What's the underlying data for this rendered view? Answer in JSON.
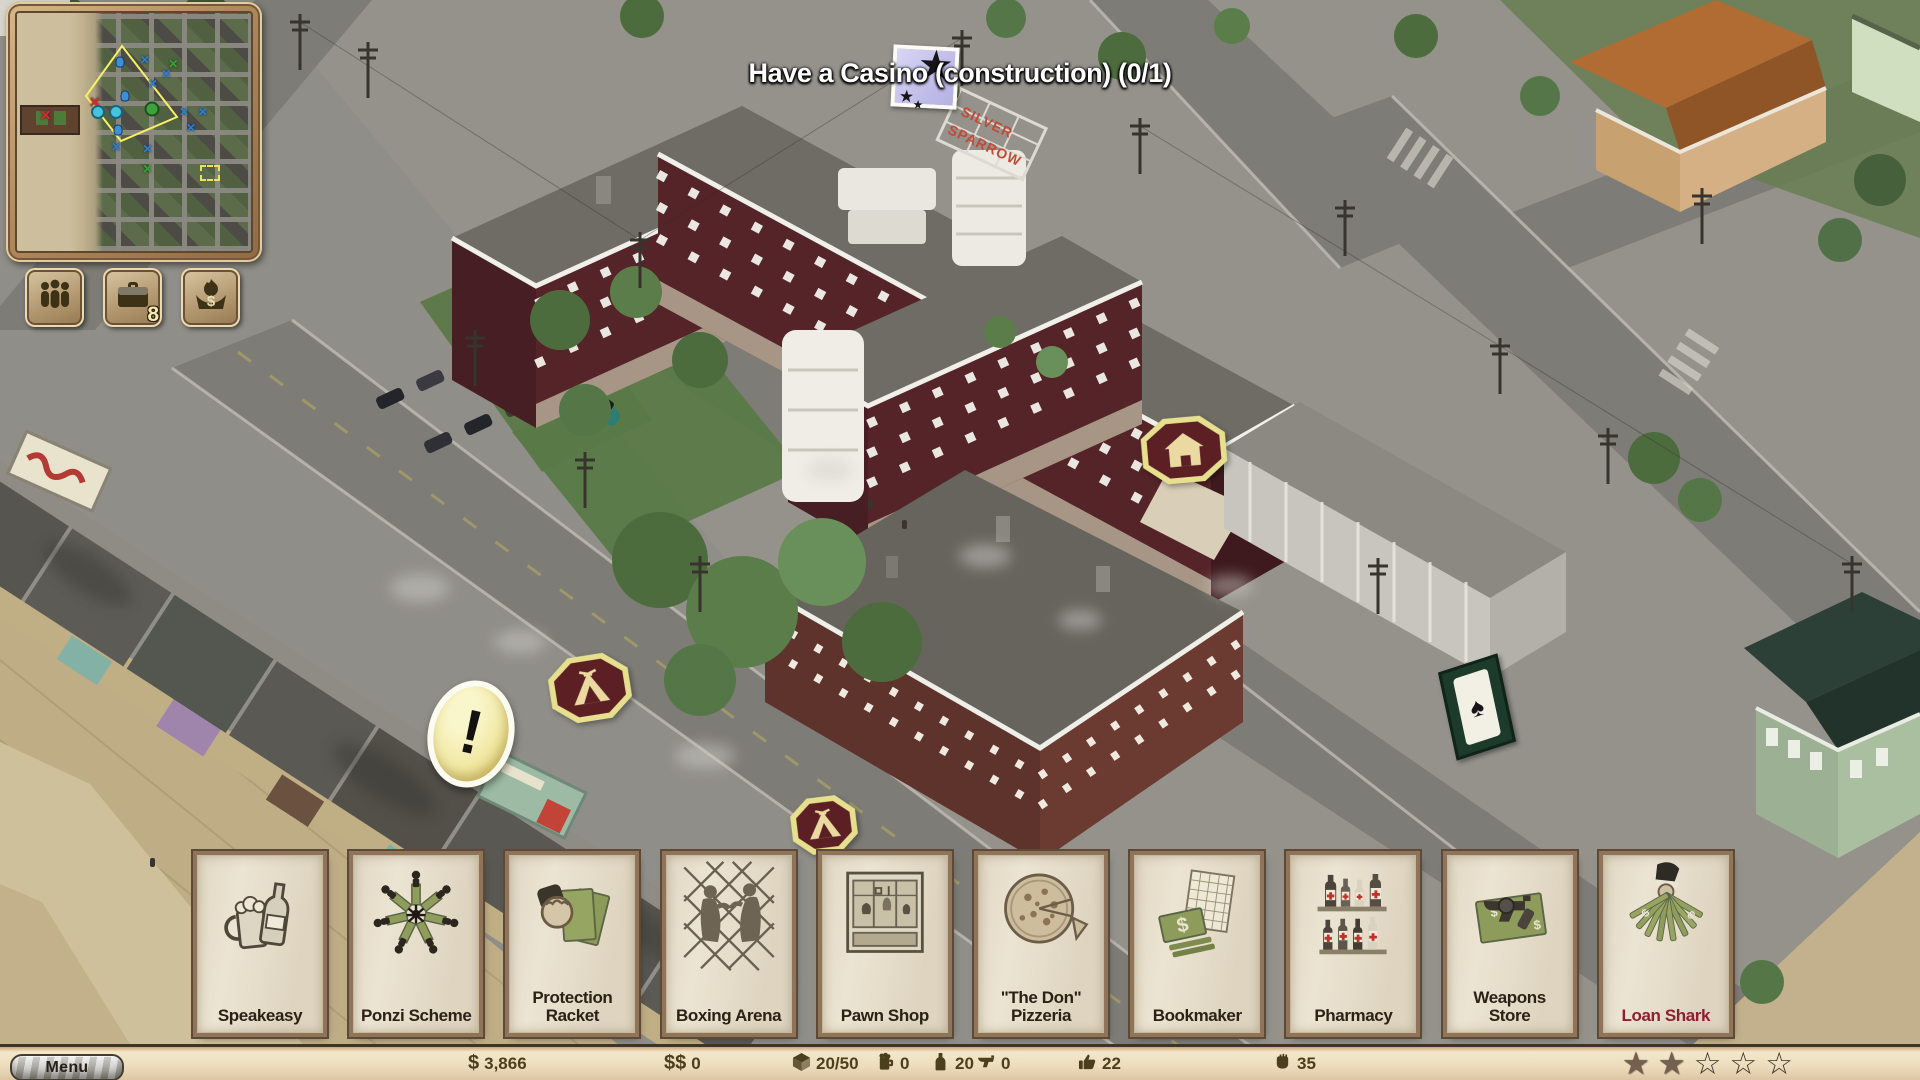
{
  "colors": {
    "hud_cream": "#ecdcbc",
    "wood_frame": "#b08a5c",
    "badge_maroon": "#5c2024",
    "badge_yellow": "#e6df8e",
    "card_paper": "#ece4d2",
    "card_frame_brown": "#8d745a",
    "card_label": "#2b2114",
    "loan_shark_red": "#8e1f2e",
    "status_text": "#4c3f1c",
    "objective_icon_bg": "#c7c3ec",
    "minimap_viewport_yellow": "#f5f163"
  },
  "objective": {
    "icon": "star-card-icon",
    "text": "Have a Casino (construction) (0/1)"
  },
  "scene": {
    "hotel_sign_line1": "SILVER",
    "hotel_sign_line2": "SPARROW"
  },
  "minimap": {
    "buttons": [
      {
        "id": "crew",
        "icon": "people-icon",
        "badge": ""
      },
      {
        "id": "businesses",
        "icon": "briefcase-icon",
        "badge": "8"
      },
      {
        "id": "money-burn",
        "icon": "burning-money-icon",
        "badge": ""
      }
    ],
    "markers": [
      {
        "type": "x-blue",
        "x": 54.6,
        "y": 19.9
      },
      {
        "type": "x-blue",
        "x": 63.8,
        "y": 25.6
      },
      {
        "type": "x-green",
        "x": 66.8,
        "y": 21.5
      },
      {
        "type": "x-blue",
        "x": 58.0,
        "y": 30.0
      },
      {
        "type": "x-blue",
        "x": 71.4,
        "y": 41.8
      },
      {
        "type": "x-blue",
        "x": 79.4,
        "y": 41.4
      },
      {
        "type": "x-blue",
        "x": 74.3,
        "y": 48.3
      },
      {
        "type": "x-blue",
        "x": 42.4,
        "y": 56.5
      },
      {
        "type": "x-blue",
        "x": 55.8,
        "y": 57.3
      },
      {
        "type": "x-green",
        "x": 55.8,
        "y": 65.4
      },
      {
        "type": "x-red",
        "x": 12.2,
        "y": 43.0
      },
      {
        "type": "x-red",
        "x": 33.2,
        "y": 37.4
      },
      {
        "type": "dot-cyan",
        "x": 34.8,
        "y": 41.4
      },
      {
        "type": "dot-cyan",
        "x": 42.4,
        "y": 41.8
      },
      {
        "type": "dot-green",
        "x": 57.5,
        "y": 40.2
      },
      {
        "type": "person-blue",
        "x": 44.0,
        "y": 20.7
      },
      {
        "type": "person-blue",
        "x": 46.0,
        "y": 35.0
      },
      {
        "type": "person-blue",
        "x": 43.0,
        "y": 49.0
      }
    ]
  },
  "build_menu": {
    "cards": [
      {
        "label": "Speakeasy",
        "icon": "speakeasy-icon"
      },
      {
        "label": "Ponzi Scheme",
        "icon": "ponzi-scheme-icon"
      },
      {
        "label": "Protection Racket",
        "icon": "protection-racket-icon"
      },
      {
        "label": "Boxing Arena",
        "icon": "boxing-arena-icon"
      },
      {
        "label": "Pawn Shop",
        "icon": "pawn-shop-icon"
      },
      {
        "label": "\"The Don\" Pizzeria",
        "icon": "pizzeria-icon"
      },
      {
        "label": "Bookmaker",
        "icon": "bookmaker-icon"
      },
      {
        "label": "Pharmacy",
        "icon": "pharmacy-icon"
      },
      {
        "label": "Weapons Store",
        "icon": "weapons-store-icon"
      },
      {
        "label": "Loan Shark",
        "icon": "loan-shark-icon",
        "highlight": true
      }
    ]
  },
  "status_bar": {
    "menu_label": "Menu",
    "stats": [
      {
        "id": "clean-money",
        "prefix": "$",
        "value": "3,866"
      },
      {
        "id": "dirty-money",
        "prefix": "$$",
        "value": "0"
      },
      {
        "id": "storage",
        "icon": "crate-icon",
        "value": "20/50"
      },
      {
        "id": "beer",
        "icon": "beer-icon",
        "value": "0"
      },
      {
        "id": "liquor",
        "icon": "liquor-icon",
        "value": "20"
      },
      {
        "id": "guns",
        "icon": "revolver-icon",
        "value": "0"
      },
      {
        "id": "liked",
        "icon": "thumb-icon",
        "value": "22"
      },
      {
        "id": "feared",
        "icon": "fist-icon",
        "value": "35"
      }
    ],
    "rating": {
      "filled": 2,
      "total": 5
    }
  }
}
